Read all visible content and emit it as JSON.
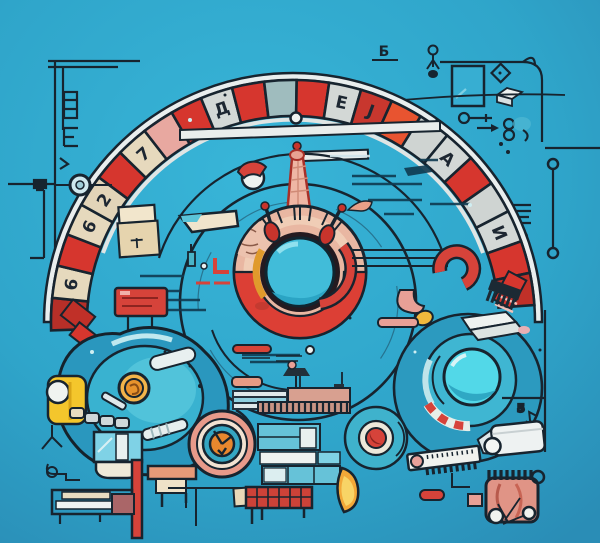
{
  "scene": {
    "description": "Surreal blueprint-style illustration: segmented red roulette arch over a central red-ring dial with teal lens, surrounded by machines, gauges, pipes and circuit doodles on a blue background",
    "palette": {
      "background": "#2fa5ca",
      "background_edge": "#2a8db6",
      "outline": "#17242f",
      "red": "#d6362e",
      "red_dark": "#b62f28",
      "orange_red": "#e85430",
      "salmon": "#e8a08c",
      "peach": "#efb6a4",
      "beige": "#e6d9bd",
      "silver": "#d3d8d6",
      "teal_gray": "#9fbcbe",
      "machine_teal": "#2a97be",
      "light_teal": "#54c4da",
      "cyan": "#52d8e8",
      "dial_teal": "#3fc0da",
      "yellow": "#f4c62c",
      "orange": "#e8932c",
      "white": "#eef2f0",
      "mauve": "#aa6668",
      "brick": "#cc4238"
    },
    "arch": {
      "segments": [
        {
          "color": "#b62f28"
        },
        {
          "color": "#e6d9bd",
          "glyph": "6"
        },
        {
          "color": "#d6362e"
        },
        {
          "color": "#e6d9bd",
          "glyph": "6"
        },
        {
          "color": "#e2d4b8",
          "glyph": "2"
        },
        {
          "color": "#d6362e"
        },
        {
          "color": "#e6d9bd",
          "glyph": "7"
        },
        {
          "color": "#e8a8a0"
        },
        {
          "color": "#d6362e"
        },
        {
          "color": "#d3d8d6",
          "glyph": "Д"
        },
        {
          "color": "#d6362e"
        },
        {
          "color": "#9fbcbe"
        },
        {
          "color": "#d6362e"
        },
        {
          "color": "#d3d8d6",
          "glyph": "E"
        },
        {
          "color": "#c8372e",
          "glyph": "J"
        },
        {
          "color": "#e85430"
        },
        {
          "color": "#cfd4d2"
        },
        {
          "color": "#d3d8d6",
          "glyph": "A"
        },
        {
          "color": "#d6362e"
        },
        {
          "color": "#cfd4d2"
        },
        {
          "color": "#d3d8d6",
          "glyph": "И"
        },
        {
          "color": "#d6362e"
        },
        {
          "color": "#c03028"
        }
      ]
    },
    "glyphs": {
      "one": "1",
      "be": "Б",
      "five": "5"
    }
  }
}
